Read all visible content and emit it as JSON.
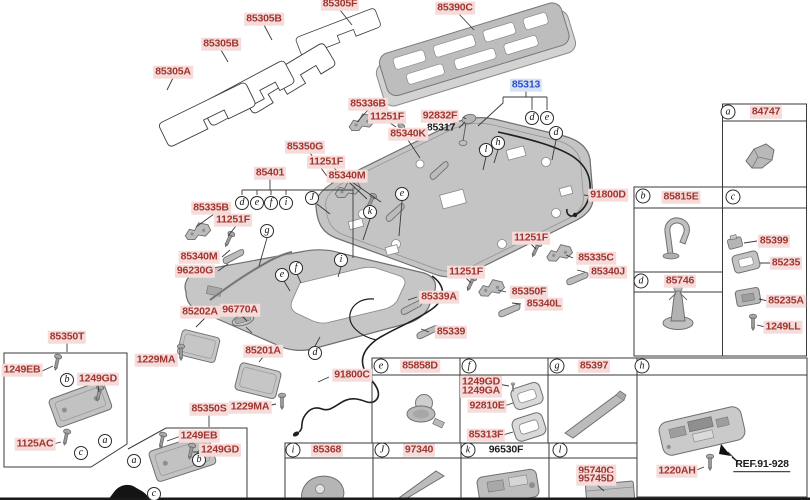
{
  "palette": {
    "label_red": "#a03530",
    "label_red_bg": "#f5dcda",
    "selected_blue": "#2b50c8",
    "selected_blue_bg": "#d7e3f5",
    "part_gray": "#c2c2c2",
    "line": "#3a3a3a"
  },
  "selected_part": "85313",
  "labels": [
    {
      "text": "85305F",
      "kind": "part",
      "x": 340,
      "y": 4
    },
    {
      "text": "85305B",
      "kind": "part",
      "x": 264,
      "y": 19
    },
    {
      "text": "85305B",
      "kind": "part",
      "x": 221,
      "y": 44
    },
    {
      "text": "85305A",
      "kind": "part",
      "x": 173,
      "y": 72
    },
    {
      "text": "85390C",
      "kind": "part",
      "x": 455,
      "y": 8
    },
    {
      "text": "85313",
      "kind": "selected",
      "x": 526,
      "y": 85
    },
    {
      "text": "85336B",
      "kind": "part",
      "x": 368,
      "y": 104
    },
    {
      "text": "11251F",
      "kind": "part",
      "x": 387,
      "y": 117
    },
    {
      "text": "92832F",
      "kind": "part",
      "x": 440,
      "y": 116
    },
    {
      "text": "85317",
      "kind": "plain",
      "x": 441,
      "y": 128
    },
    {
      "text": "85340K",
      "kind": "part",
      "x": 408,
      "y": 134
    },
    {
      "text": "85350G",
      "kind": "part",
      "x": 305,
      "y": 147
    },
    {
      "text": "11251F",
      "kind": "part",
      "x": 326,
      "y": 162
    },
    {
      "text": "85340M",
      "kind": "part",
      "x": 347,
      "y": 176
    },
    {
      "text": "85401",
      "kind": "part",
      "x": 270,
      "y": 173
    },
    {
      "text": "91800D",
      "kind": "part",
      "x": 608,
      "y": 195
    },
    {
      "text": "85335B",
      "kind": "part",
      "x": 211,
      "y": 208
    },
    {
      "text": "11251F",
      "kind": "part",
      "x": 233,
      "y": 220
    },
    {
      "text": "85340M",
      "kind": "part",
      "x": 199,
      "y": 257
    },
    {
      "text": "96230G",
      "kind": "part",
      "x": 195,
      "y": 271
    },
    {
      "text": "11251F",
      "kind": "part",
      "x": 531,
      "y": 238
    },
    {
      "text": "85335C",
      "kind": "part",
      "x": 596,
      "y": 258
    },
    {
      "text": "85340J",
      "kind": "part",
      "x": 608,
      "y": 272
    },
    {
      "text": "11251F",
      "kind": "part",
      "x": 466,
      "y": 272
    },
    {
      "text": "85350F",
      "kind": "part",
      "x": 529,
      "y": 292
    },
    {
      "text": "85340L",
      "kind": "part",
      "x": 544,
      "y": 304
    },
    {
      "text": "85339A",
      "kind": "part",
      "x": 439,
      "y": 297
    },
    {
      "text": "85339",
      "kind": "part",
      "x": 451,
      "y": 332
    },
    {
      "text": "85202A",
      "kind": "part",
      "x": 200,
      "y": 312
    },
    {
      "text": "96770A",
      "kind": "part",
      "x": 240,
      "y": 310
    },
    {
      "text": "85201A",
      "kind": "part",
      "x": 263,
      "y": 351
    },
    {
      "text": "1229MA",
      "kind": "part",
      "x": 156,
      "y": 360
    },
    {
      "text": "85350T",
      "kind": "part",
      "x": 67,
      "y": 337
    },
    {
      "text": "1249EB",
      "kind": "part",
      "x": 22,
      "y": 370
    },
    {
      "text": "1249GD",
      "kind": "part",
      "x": 98,
      "y": 379
    },
    {
      "text": "1125AC",
      "kind": "part",
      "x": 35,
      "y": 444
    },
    {
      "text": "91800C",
      "kind": "part",
      "x": 352,
      "y": 375
    },
    {
      "text": "85350S",
      "kind": "part",
      "x": 209,
      "y": 409
    },
    {
      "text": "1229MA",
      "kind": "part",
      "x": 250,
      "y": 407
    },
    {
      "text": "1249EB",
      "kind": "part",
      "x": 199,
      "y": 436
    },
    {
      "text": "1249GD",
      "kind": "part",
      "x": 220,
      "y": 450
    },
    {
      "text": "84747",
      "kind": "part",
      "x": 766,
      "y": 112
    },
    {
      "text": "85815E",
      "kind": "part",
      "x": 681,
      "y": 197
    },
    {
      "text": "85399",
      "kind": "part",
      "x": 774,
      "y": 241
    },
    {
      "text": "85235",
      "kind": "part",
      "x": 786,
      "y": 263
    },
    {
      "text": "85235A",
      "kind": "part",
      "x": 786,
      "y": 301
    },
    {
      "text": "1249LL",
      "kind": "part",
      "x": 783,
      "y": 327
    },
    {
      "text": "85746",
      "kind": "part",
      "x": 680,
      "y": 281
    },
    {
      "text": "85858D",
      "kind": "part",
      "x": 420,
      "y": 366
    },
    {
      "text": "1249GD",
      "kind": "part",
      "x": 481,
      "y": 382
    },
    {
      "text": "1249GA",
      "kind": "part",
      "x": 481,
      "y": 391
    },
    {
      "text": "92810E",
      "kind": "part",
      "x": 487,
      "y": 406
    },
    {
      "text": "85313F",
      "kind": "part",
      "x": 486,
      "y": 435
    },
    {
      "text": "85397",
      "kind": "part",
      "x": 594,
      "y": 366
    },
    {
      "text": "85368",
      "kind": "part",
      "x": 327,
      "y": 450
    },
    {
      "text": "97340",
      "kind": "part",
      "x": 419,
      "y": 450
    },
    {
      "text": "96530F",
      "kind": "plain",
      "x": 506,
      "y": 450
    },
    {
      "text": "95740C",
      "kind": "part",
      "x": 596,
      "y": 471
    },
    {
      "text": "95745D",
      "kind": "part",
      "x": 596,
      "y": 479
    },
    {
      "text": "1220AH",
      "kind": "part",
      "x": 677,
      "y": 471
    },
    {
      "text": "REF.91-928",
      "kind": "ref",
      "x": 762,
      "y": 465
    }
  ],
  "callouts": [
    {
      "letter": "a",
      "x": 728,
      "y": 112,
      "hdr": true
    },
    {
      "letter": "b",
      "x": 643,
      "y": 196,
      "hdr": true
    },
    {
      "letter": "c",
      "x": 733,
      "y": 197,
      "hdr": true
    },
    {
      "letter": "d",
      "x": 641,
      "y": 281,
      "hdr": true
    },
    {
      "letter": "e",
      "x": 381,
      "y": 366,
      "hdr": true
    },
    {
      "letter": "f",
      "x": 469,
      "y": 366,
      "hdr": true
    },
    {
      "letter": "g",
      "x": 557,
      "y": 366,
      "hdr": true
    },
    {
      "letter": "h",
      "x": 642,
      "y": 366,
      "hdr": true
    },
    {
      "letter": "i",
      "x": 293,
      "y": 450,
      "hdr": true
    },
    {
      "letter": "J",
      "x": 382,
      "y": 450,
      "hdr": true
    },
    {
      "letter": "k",
      "x": 468,
      "y": 450,
      "hdr": true
    },
    {
      "letter": "l",
      "x": 560,
      "y": 450,
      "hdr": true
    },
    {
      "letter": "d",
      "x": 532,
      "y": 118,
      "hdr": false
    },
    {
      "letter": "e",
      "x": 547,
      "y": 118,
      "hdr": false
    },
    {
      "letter": "d",
      "x": 556,
      "y": 133,
      "hdr": false
    },
    {
      "letter": "h",
      "x": 498,
      "y": 143,
      "hdr": false
    },
    {
      "letter": "l",
      "x": 486,
      "y": 150,
      "hdr": false
    },
    {
      "letter": "e",
      "x": 402,
      "y": 194,
      "hdr": false
    },
    {
      "letter": "J",
      "x": 312,
      "y": 198,
      "hdr": false
    },
    {
      "letter": "k",
      "x": 370,
      "y": 212,
      "hdr": false
    },
    {
      "letter": "d",
      "x": 242,
      "y": 203,
      "hdr": false
    },
    {
      "letter": "e",
      "x": 257,
      "y": 203,
      "hdr": false
    },
    {
      "letter": "f",
      "x": 271,
      "y": 203,
      "hdr": false
    },
    {
      "letter": "i",
      "x": 286,
      "y": 203,
      "hdr": false
    },
    {
      "letter": "g",
      "x": 267,
      "y": 231,
      "hdr": false
    },
    {
      "letter": "f",
      "x": 296,
      "y": 268,
      "hdr": false
    },
    {
      "letter": "e",
      "x": 282,
      "y": 275,
      "hdr": false
    },
    {
      "letter": "i",
      "x": 341,
      "y": 260,
      "hdr": false
    },
    {
      "letter": "d",
      "x": 315,
      "y": 353,
      "hdr": false
    },
    {
      "letter": "b",
      "x": 67,
      "y": 380,
      "hdr": false
    },
    {
      "letter": "a",
      "x": 105,
      "y": 441,
      "hdr": false
    },
    {
      "letter": "c",
      "x": 81,
      "y": 453,
      "hdr": false
    },
    {
      "letter": "a",
      "x": 134,
      "y": 461,
      "hdr": false
    },
    {
      "letter": "b",
      "x": 199,
      "y": 460,
      "hdr": false
    },
    {
      "letter": "c",
      "x": 154,
      "y": 494,
      "hdr": false
    }
  ]
}
